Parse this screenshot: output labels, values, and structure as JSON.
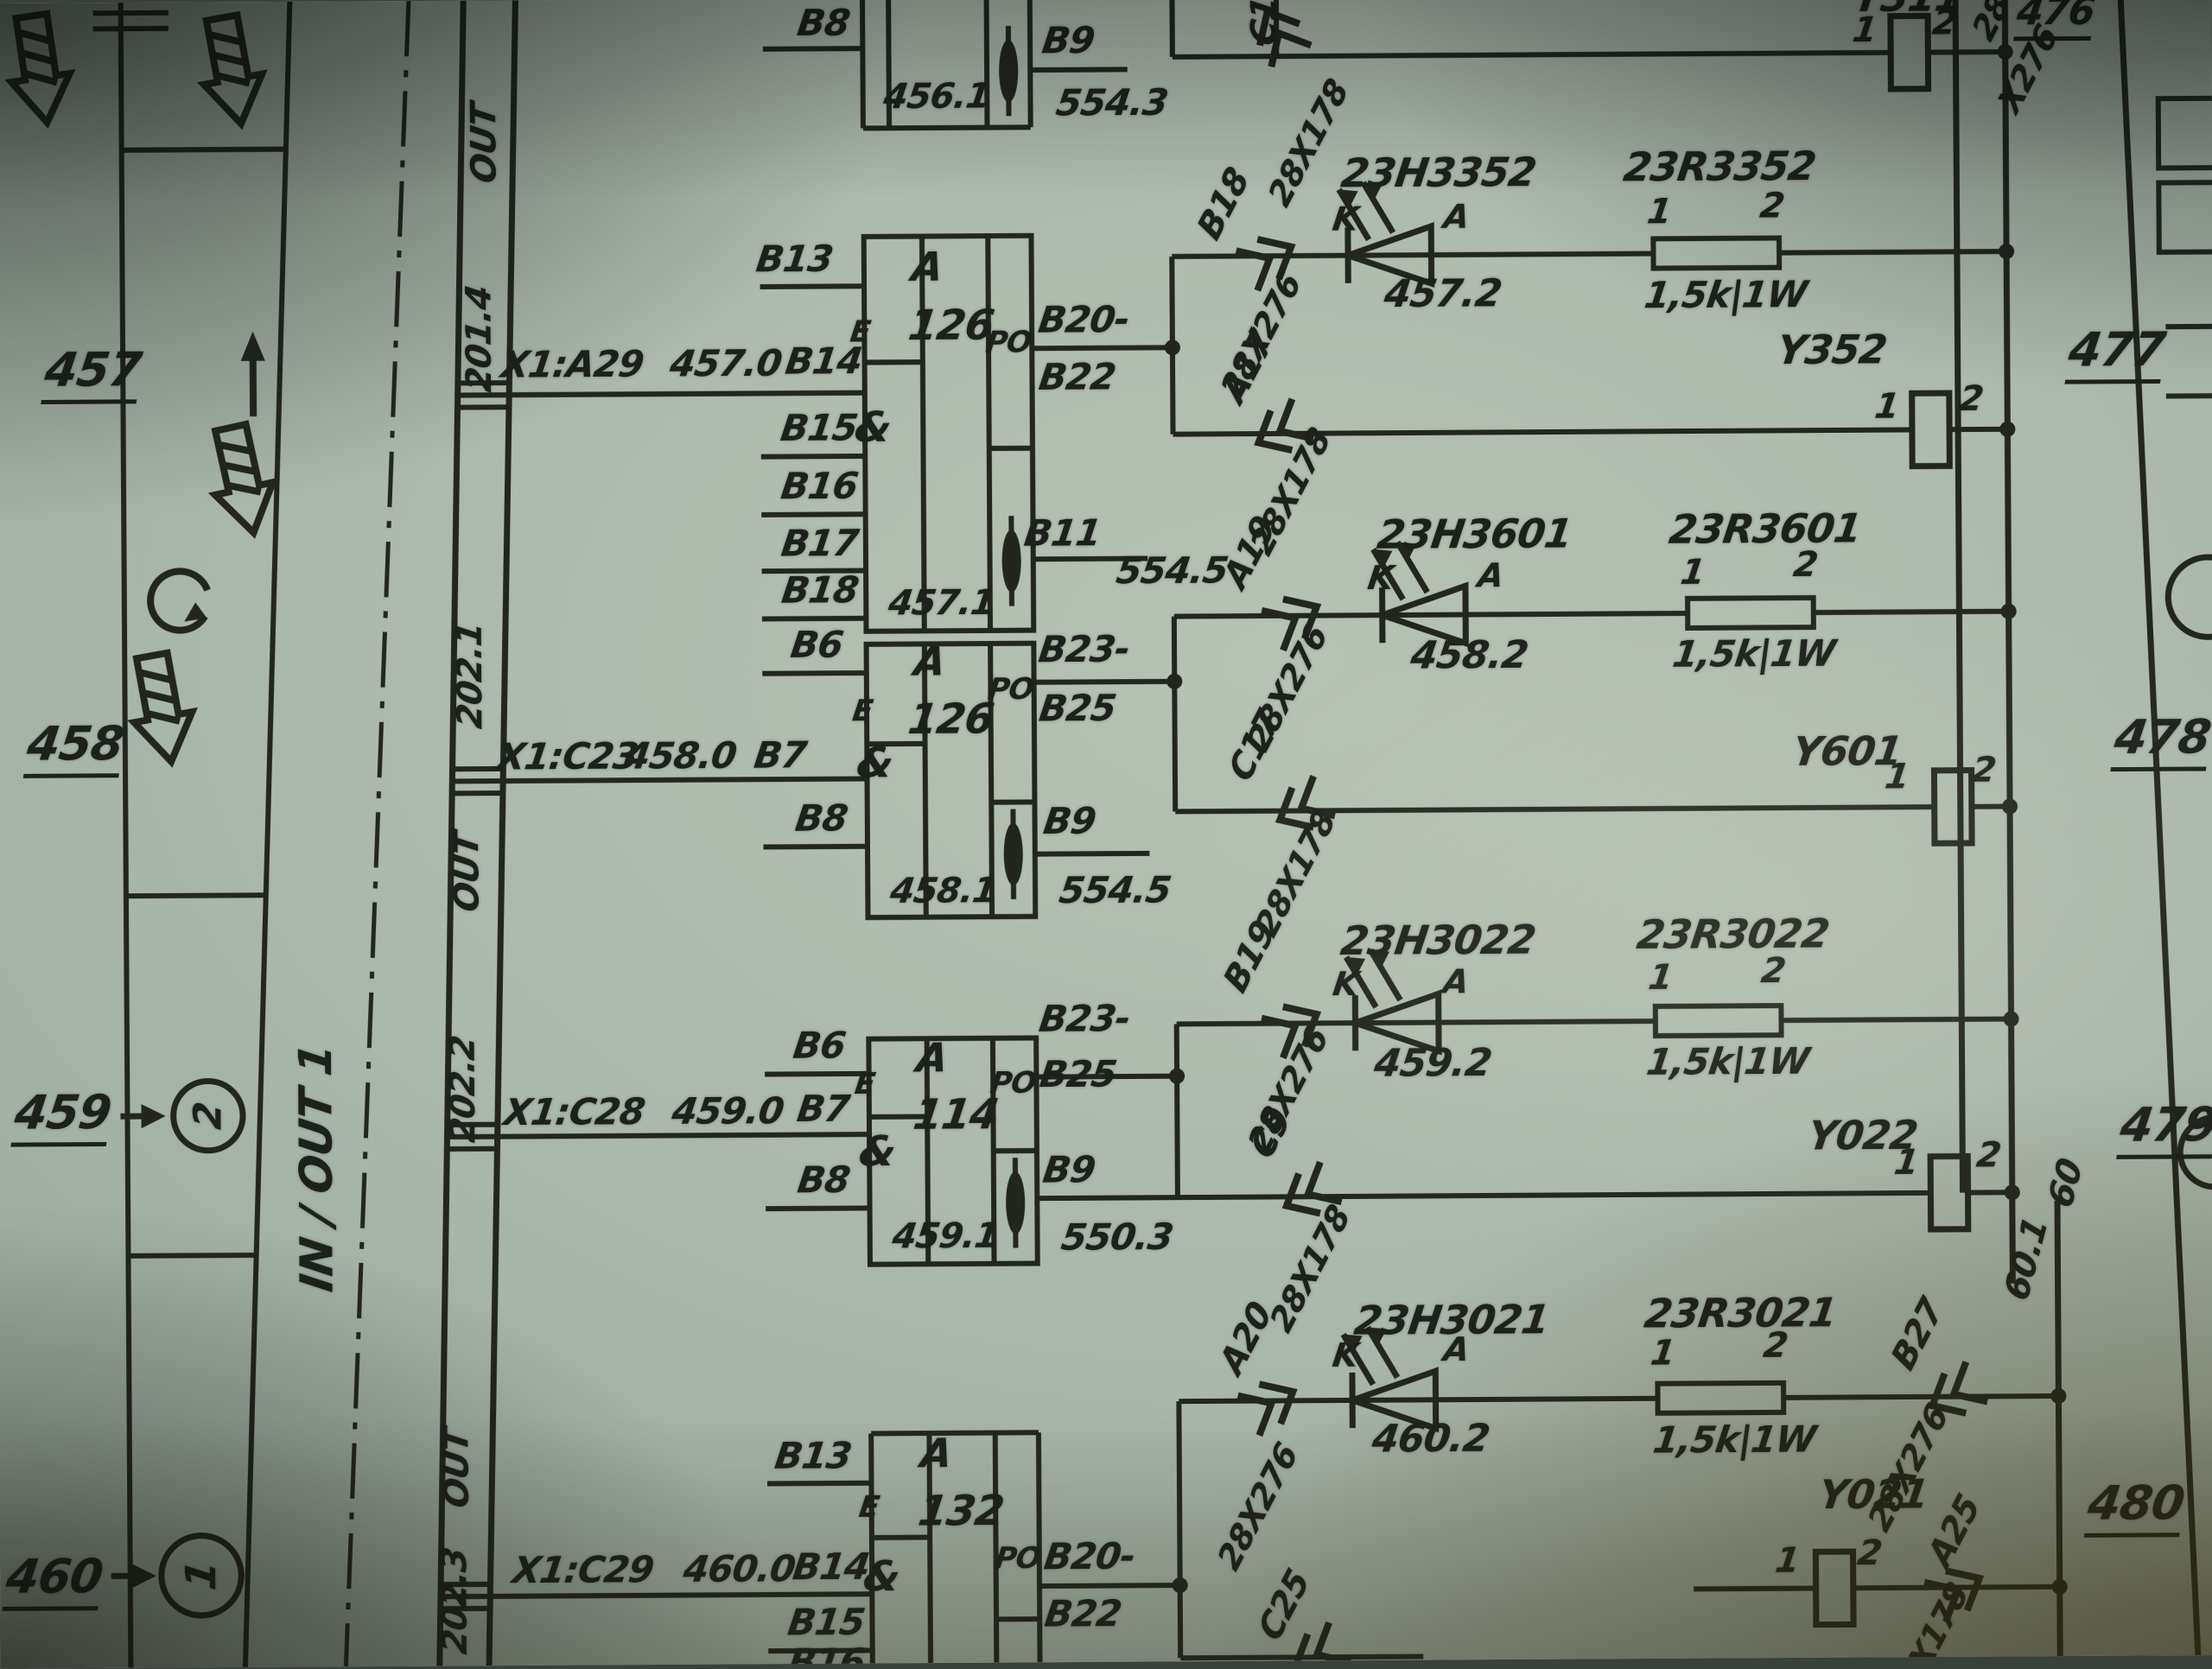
{
  "left_margin": {
    "r457": "457",
    "r458": "458",
    "r459": "459",
    "r460": "460",
    "circle_2": "2",
    "circle_1": "1",
    "inout": "IN / OUT 1"
  },
  "right_margin": {
    "r476": "476",
    "r477": "477",
    "r478": "478",
    "r479": "479",
    "r480": "480"
  },
  "bus": {
    "out": "OUT",
    "t201_4": "201.4",
    "t202_1": "202.1",
    "t202_2": "202.2",
    "t202_3": "202.3",
    "n60_1": "60.1",
    "n60": "60"
  },
  "feeds": {
    "x1_a29": "X1:A29",
    "v457_0": "457.0",
    "x1_c23": "X1:C23",
    "v458_0": "458.0",
    "x1_c28": "X1:C28",
    "v459_0": "459.0",
    "x1_c29": "X1:C29",
    "v460_0": "460.0"
  },
  "pins": {
    "b6": "B6",
    "b7": "B7",
    "b8": "B8",
    "b9": "B9",
    "b11": "B11",
    "b13": "B13",
    "b14": "B14",
    "b15": "B15",
    "b16": "B16",
    "b17": "B17",
    "b18": "B18",
    "b20": "B20-",
    "b22": "B22",
    "b23": "B23-",
    "b25": "B25",
    "e": "E",
    "amp": "&",
    "po": "PO",
    "one": "1",
    "two": "2",
    "k": "K",
    "an": "A"
  },
  "blocks": {
    "a": "A",
    "n126": "126",
    "n114": "114",
    "n132": "132",
    "s456_1": "456.1",
    "s457_1": "457.1",
    "s458_1": "458.1",
    "s459_1": "459.1"
  },
  "dests": {
    "d554_3": "554.3",
    "d554_5": "554.5",
    "d550_3": "550.3"
  },
  "leds": {
    "h3352": "23H3352",
    "n457_2": "457.2",
    "h3601": "23H3601",
    "n458_2": "458.2",
    "h3022": "23H3022",
    "n459_2": "459.2",
    "h3021": "23H3021",
    "n460_2": "460.2"
  },
  "resistors": {
    "r3352": "23R3352",
    "r3601": "23R3601",
    "r3022": "23R3022",
    "r3021": "23R3021",
    "value": "1,5k|1W"
  },
  "relays": {
    "y311": "Y311",
    "y352": "Y352",
    "y601": "Y601",
    "y022": "Y022",
    "y021": "Y021"
  },
  "cables": {
    "c276": "28X276",
    "c178": "28X178",
    "c28": "28",
    "x276": "X276"
  },
  "wires": {
    "c15": "C15",
    "b18": "B18",
    "a17": "A17",
    "a19": "A19",
    "c17": "C17",
    "b19": "B19",
    "c9": "C9",
    "a20": "A20",
    "b27": "B27",
    "c25": "C25",
    "a25": "A25"
  }
}
